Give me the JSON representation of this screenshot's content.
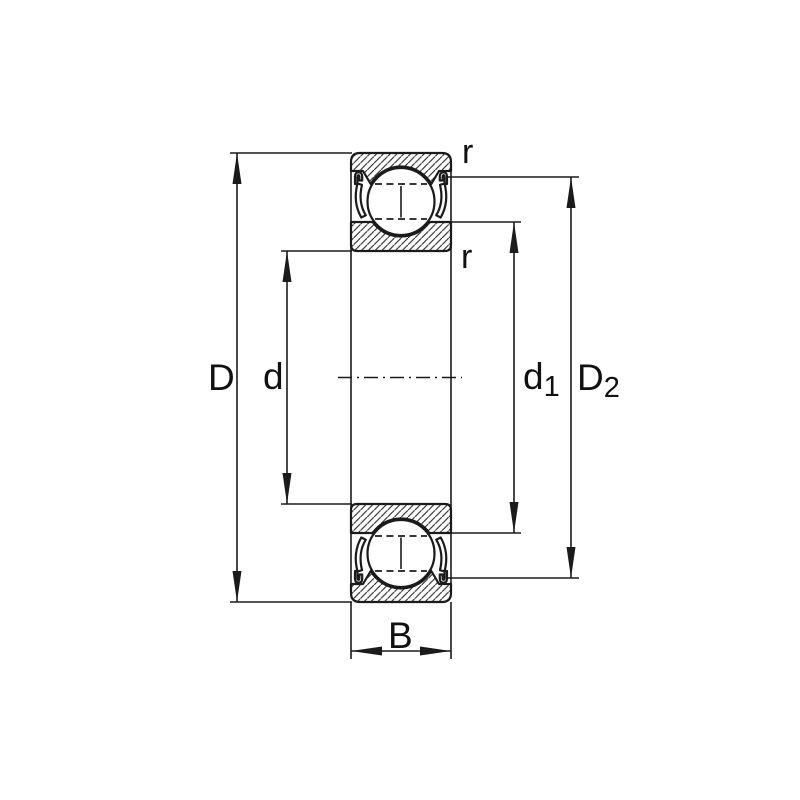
{
  "title": "Deep groove ball bearing (shielded) dimension drawing",
  "labels": {
    "outer_diameter": "D",
    "bore_diameter": "d",
    "shoulder_diameter_base": "d",
    "shoulder_diameter_sub": "1",
    "recess_diameter_base": "D",
    "recess_diameter_sub": "2",
    "width": "B",
    "chamfer_radius_outer": "r",
    "chamfer_radius_inner": "r"
  },
  "colors": {
    "line": "#1b1b1b",
    "background": "#ffffff"
  }
}
